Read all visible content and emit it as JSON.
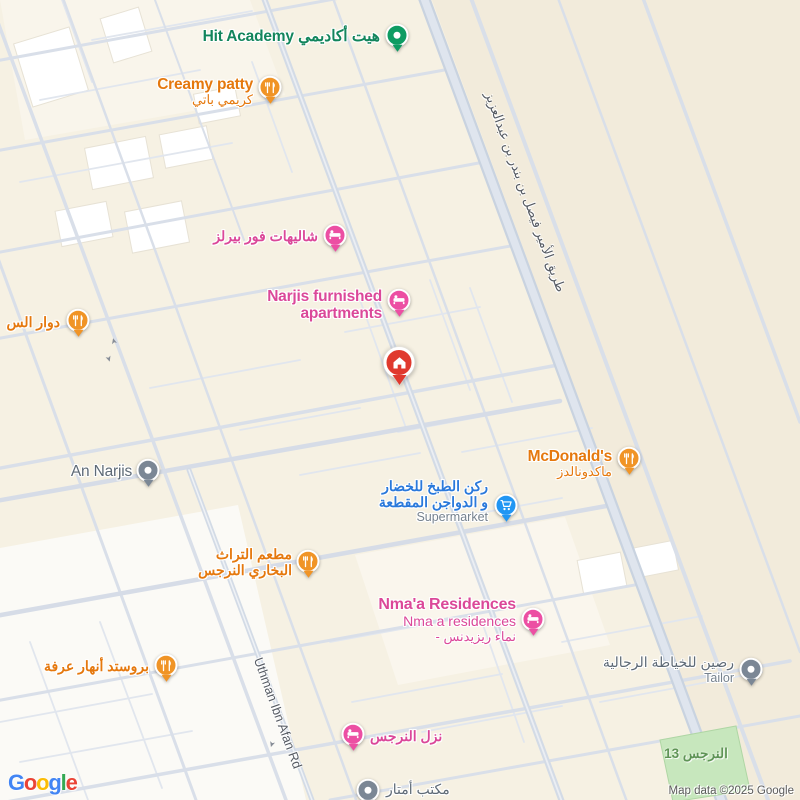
{
  "road_labels": {
    "prince_faisal": "طريق الأمير فيصل بن بندر بن عبدالعزيز",
    "uthman": "Uthman Ibn Afan Rd"
  },
  "park": {
    "name": "النرجس 13"
  },
  "pois": {
    "hit_academy": {
      "label": "هيت أكاديمي Hit Academy"
    },
    "creamy_patty": {
      "name": "Creamy patty",
      "name_ar": "كريمي باتي"
    },
    "dawar": {
      "name_ar": "دوار الس"
    },
    "chalets": {
      "name_ar": "شاليهات فور بيرلز"
    },
    "narjis_apartments": {
      "line1": "Narjis furnished",
      "line2": "apartments"
    },
    "mcdonalds": {
      "name": "McDonald's",
      "name_ar": "ماكدونالدز"
    },
    "supermarket": {
      "line1": "ركن الطبخ للخضار",
      "line2": "و الدواجن المقطعة",
      "category": "Supermarket"
    },
    "an_narjis": {
      "name": "An Narjis"
    },
    "bukhari_restaurant": {
      "line1": "مطعم التراث",
      "line2": "البخاري النرجس"
    },
    "nmaa_residences": {
      "line1": "Nma'a Residences",
      "line2": "Nma a residences",
      "line3": "- نماء ريزيدنس"
    },
    "broasted": {
      "name_ar": "بروستد أنهار عرفة"
    },
    "tailor": {
      "name_ar": "رصين للخياطة الرجالية",
      "category": "Tailor"
    },
    "nazl_narjis": {
      "name_ar": "نزل النرجس"
    },
    "amtar_office": {
      "name_ar": "مكتب أمتار"
    }
  },
  "icons": {
    "one_way_arrow": "➤"
  },
  "logo": {
    "letters": [
      "G",
      "o",
      "o",
      "g",
      "l",
      "e"
    ]
  },
  "attribution": {
    "text": "Map data ©2025 Google"
  },
  "colors": {
    "food_marker": "#F09426",
    "lodging_marker": "#EC4FA3",
    "supermarket_marker": "#2196F3",
    "school_marker": "#0E9C63",
    "generic_marker": "#7B8795",
    "destination_marker": "#E0392E",
    "food_label": "#E5780D",
    "lodging_label": "#DB4899",
    "supermarket_label": "#2A79DB",
    "generic_label": "#5E6A76",
    "school_label": "#12855C",
    "park_fill": "#C7E7BD",
    "park_label": "#5F9456",
    "road_label": "#565B63",
    "logo_letter_colors": [
      "#4285F4",
      "#EA4335",
      "#FBBC05",
      "#4285F4",
      "#34A853",
      "#EA4335"
    ]
  }
}
